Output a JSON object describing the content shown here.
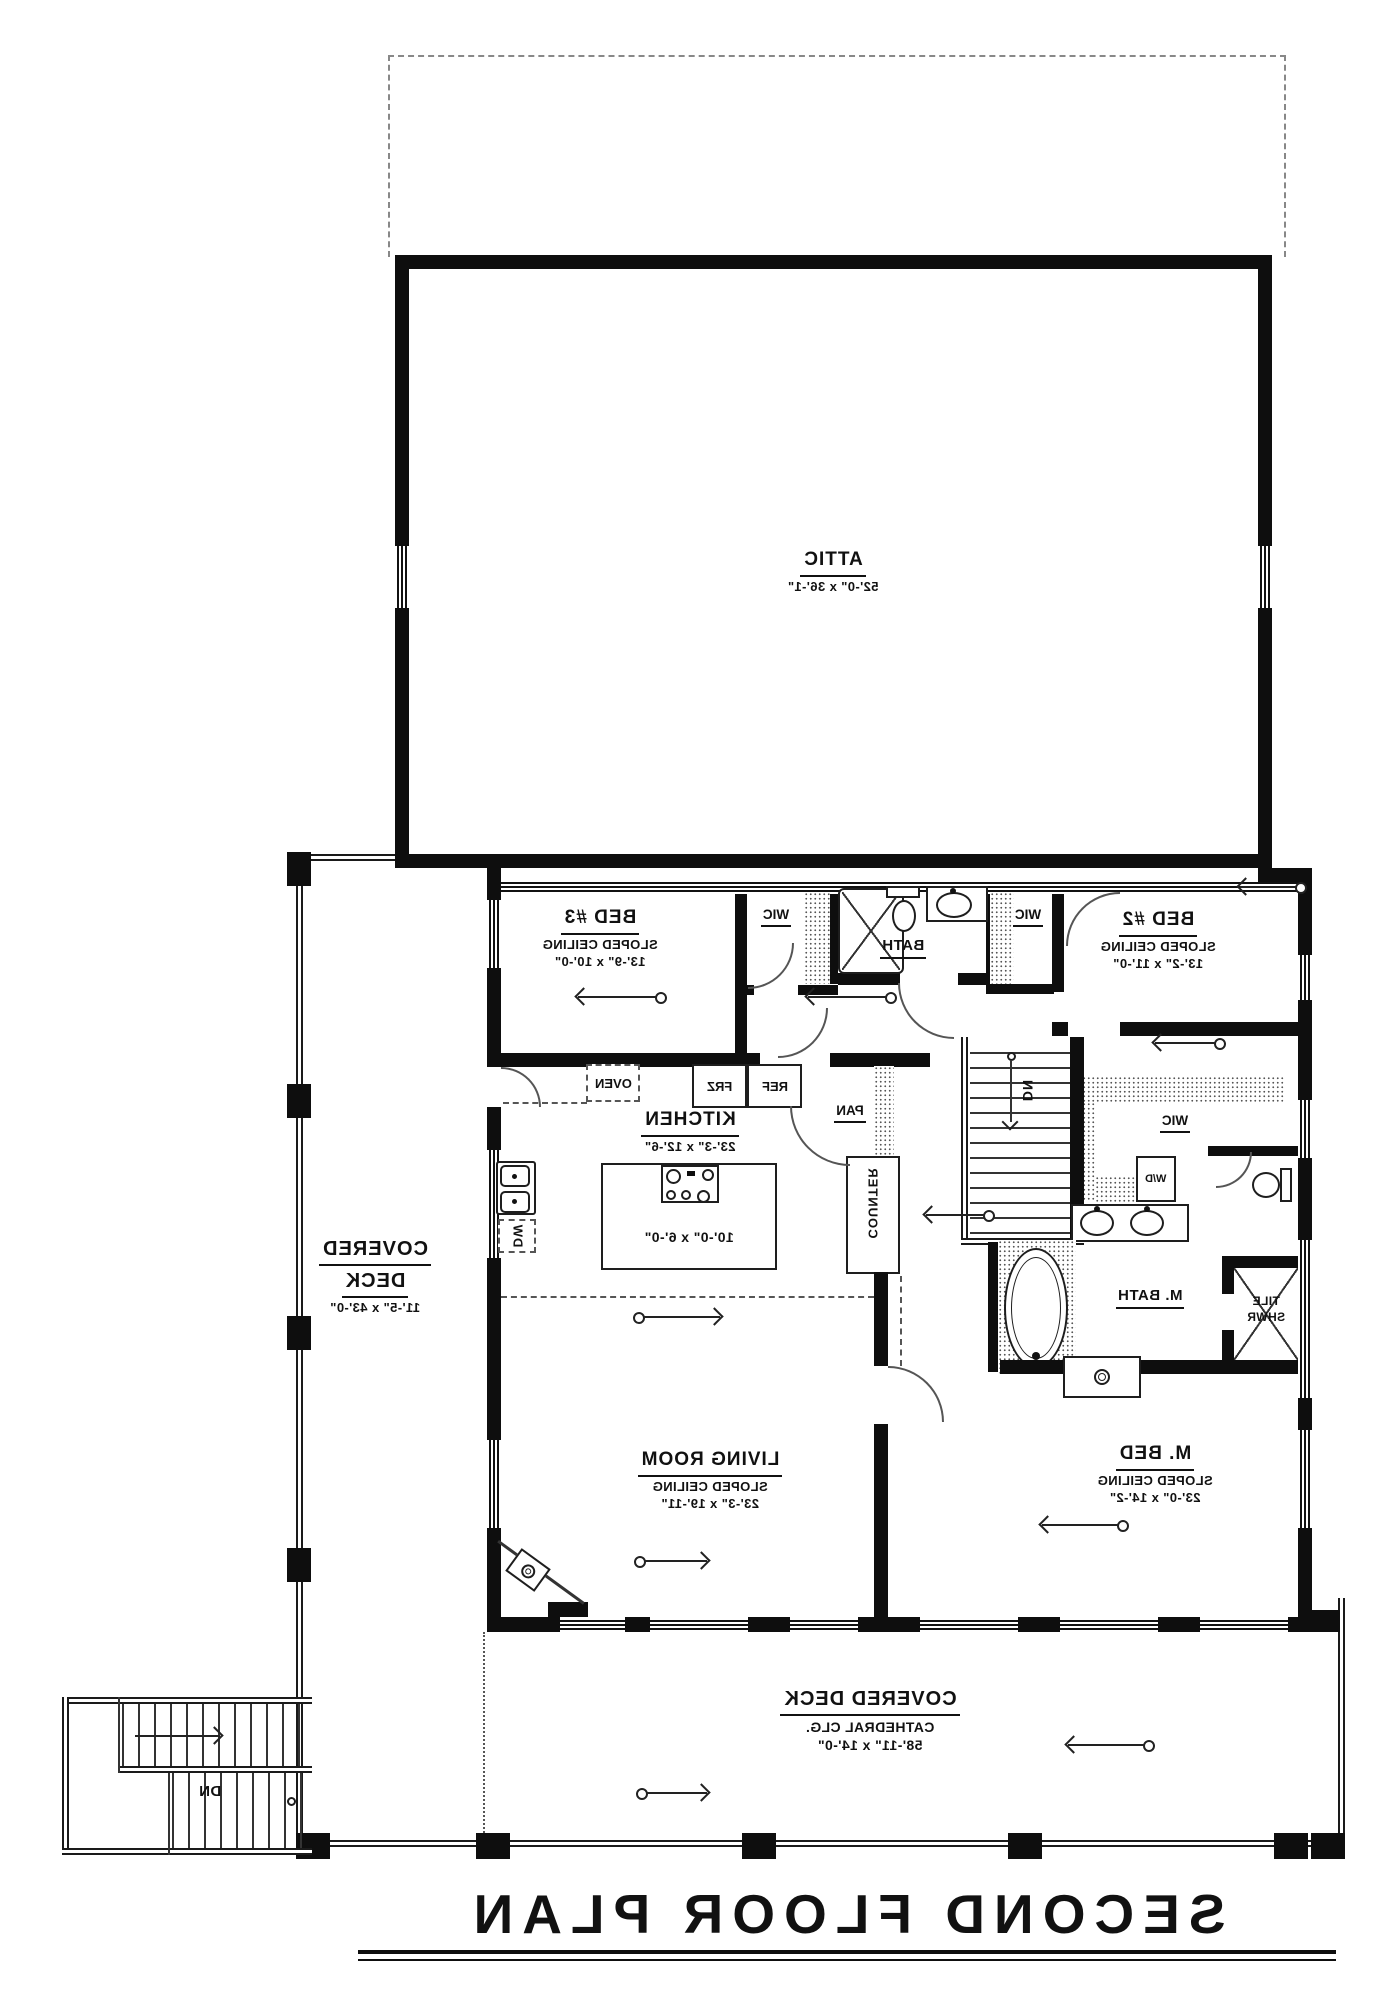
{
  "colors": {
    "ink": "#111111",
    "background": "#ffffff"
  },
  "title": {
    "text": "SECOND FLOOR PLAN"
  },
  "attic": {
    "name": "ATTIC",
    "dims": "52'-0\" x 36'-1\""
  },
  "bed3": {
    "name": "BED #3",
    "ceiling": "SLOPED CEILING",
    "dims": "13'-9\" x 10'-0\""
  },
  "bed2": {
    "name": "BED #2",
    "ceiling": "SLOPED CEILING",
    "dims": "13'-2\" x 11'-0\""
  },
  "bath": {
    "name": "BATH"
  },
  "wic1": {
    "name": "WIC"
  },
  "wic2": {
    "name": "WIC"
  },
  "wic3": {
    "name": "WIC"
  },
  "kitchen": {
    "name": "KITCHEN",
    "dims": "23'-3\" x 12'-6\""
  },
  "island": {
    "dims": "10'-0\" x 6'-0\""
  },
  "pantry": {
    "name": "PAN"
  },
  "counter": {
    "name": "COUNTER"
  },
  "appliances": {
    "oven": "OVEN",
    "frz": "FRZ",
    "ref": "REF",
    "dw": "DW",
    "wd": "W/D"
  },
  "living": {
    "name": "LIVING ROOM",
    "ceiling": "SLOPED CEILING",
    "dims": "23'-3\" x 19'-11\""
  },
  "mbed": {
    "name": "M. BED",
    "ceiling": "SLOPED CEILING",
    "dims": "23'-0\" x 14'-2\""
  },
  "mbath": {
    "name": "M. BATH"
  },
  "shower": {
    "line1": "TILE",
    "line2": "SHWR"
  },
  "deck_left": {
    "line1": "COVERED",
    "line2": "DECK",
    "dims": "11'-5\" x 43'-0\""
  },
  "deck_bottom": {
    "name": "COVERED DECK",
    "ceiling": "CATHEDRAL CLG.",
    "dims": "58'-11\" x 14'-0\""
  },
  "stairs": {
    "dn_interior": "DN",
    "dn_exterior": "DN"
  }
}
